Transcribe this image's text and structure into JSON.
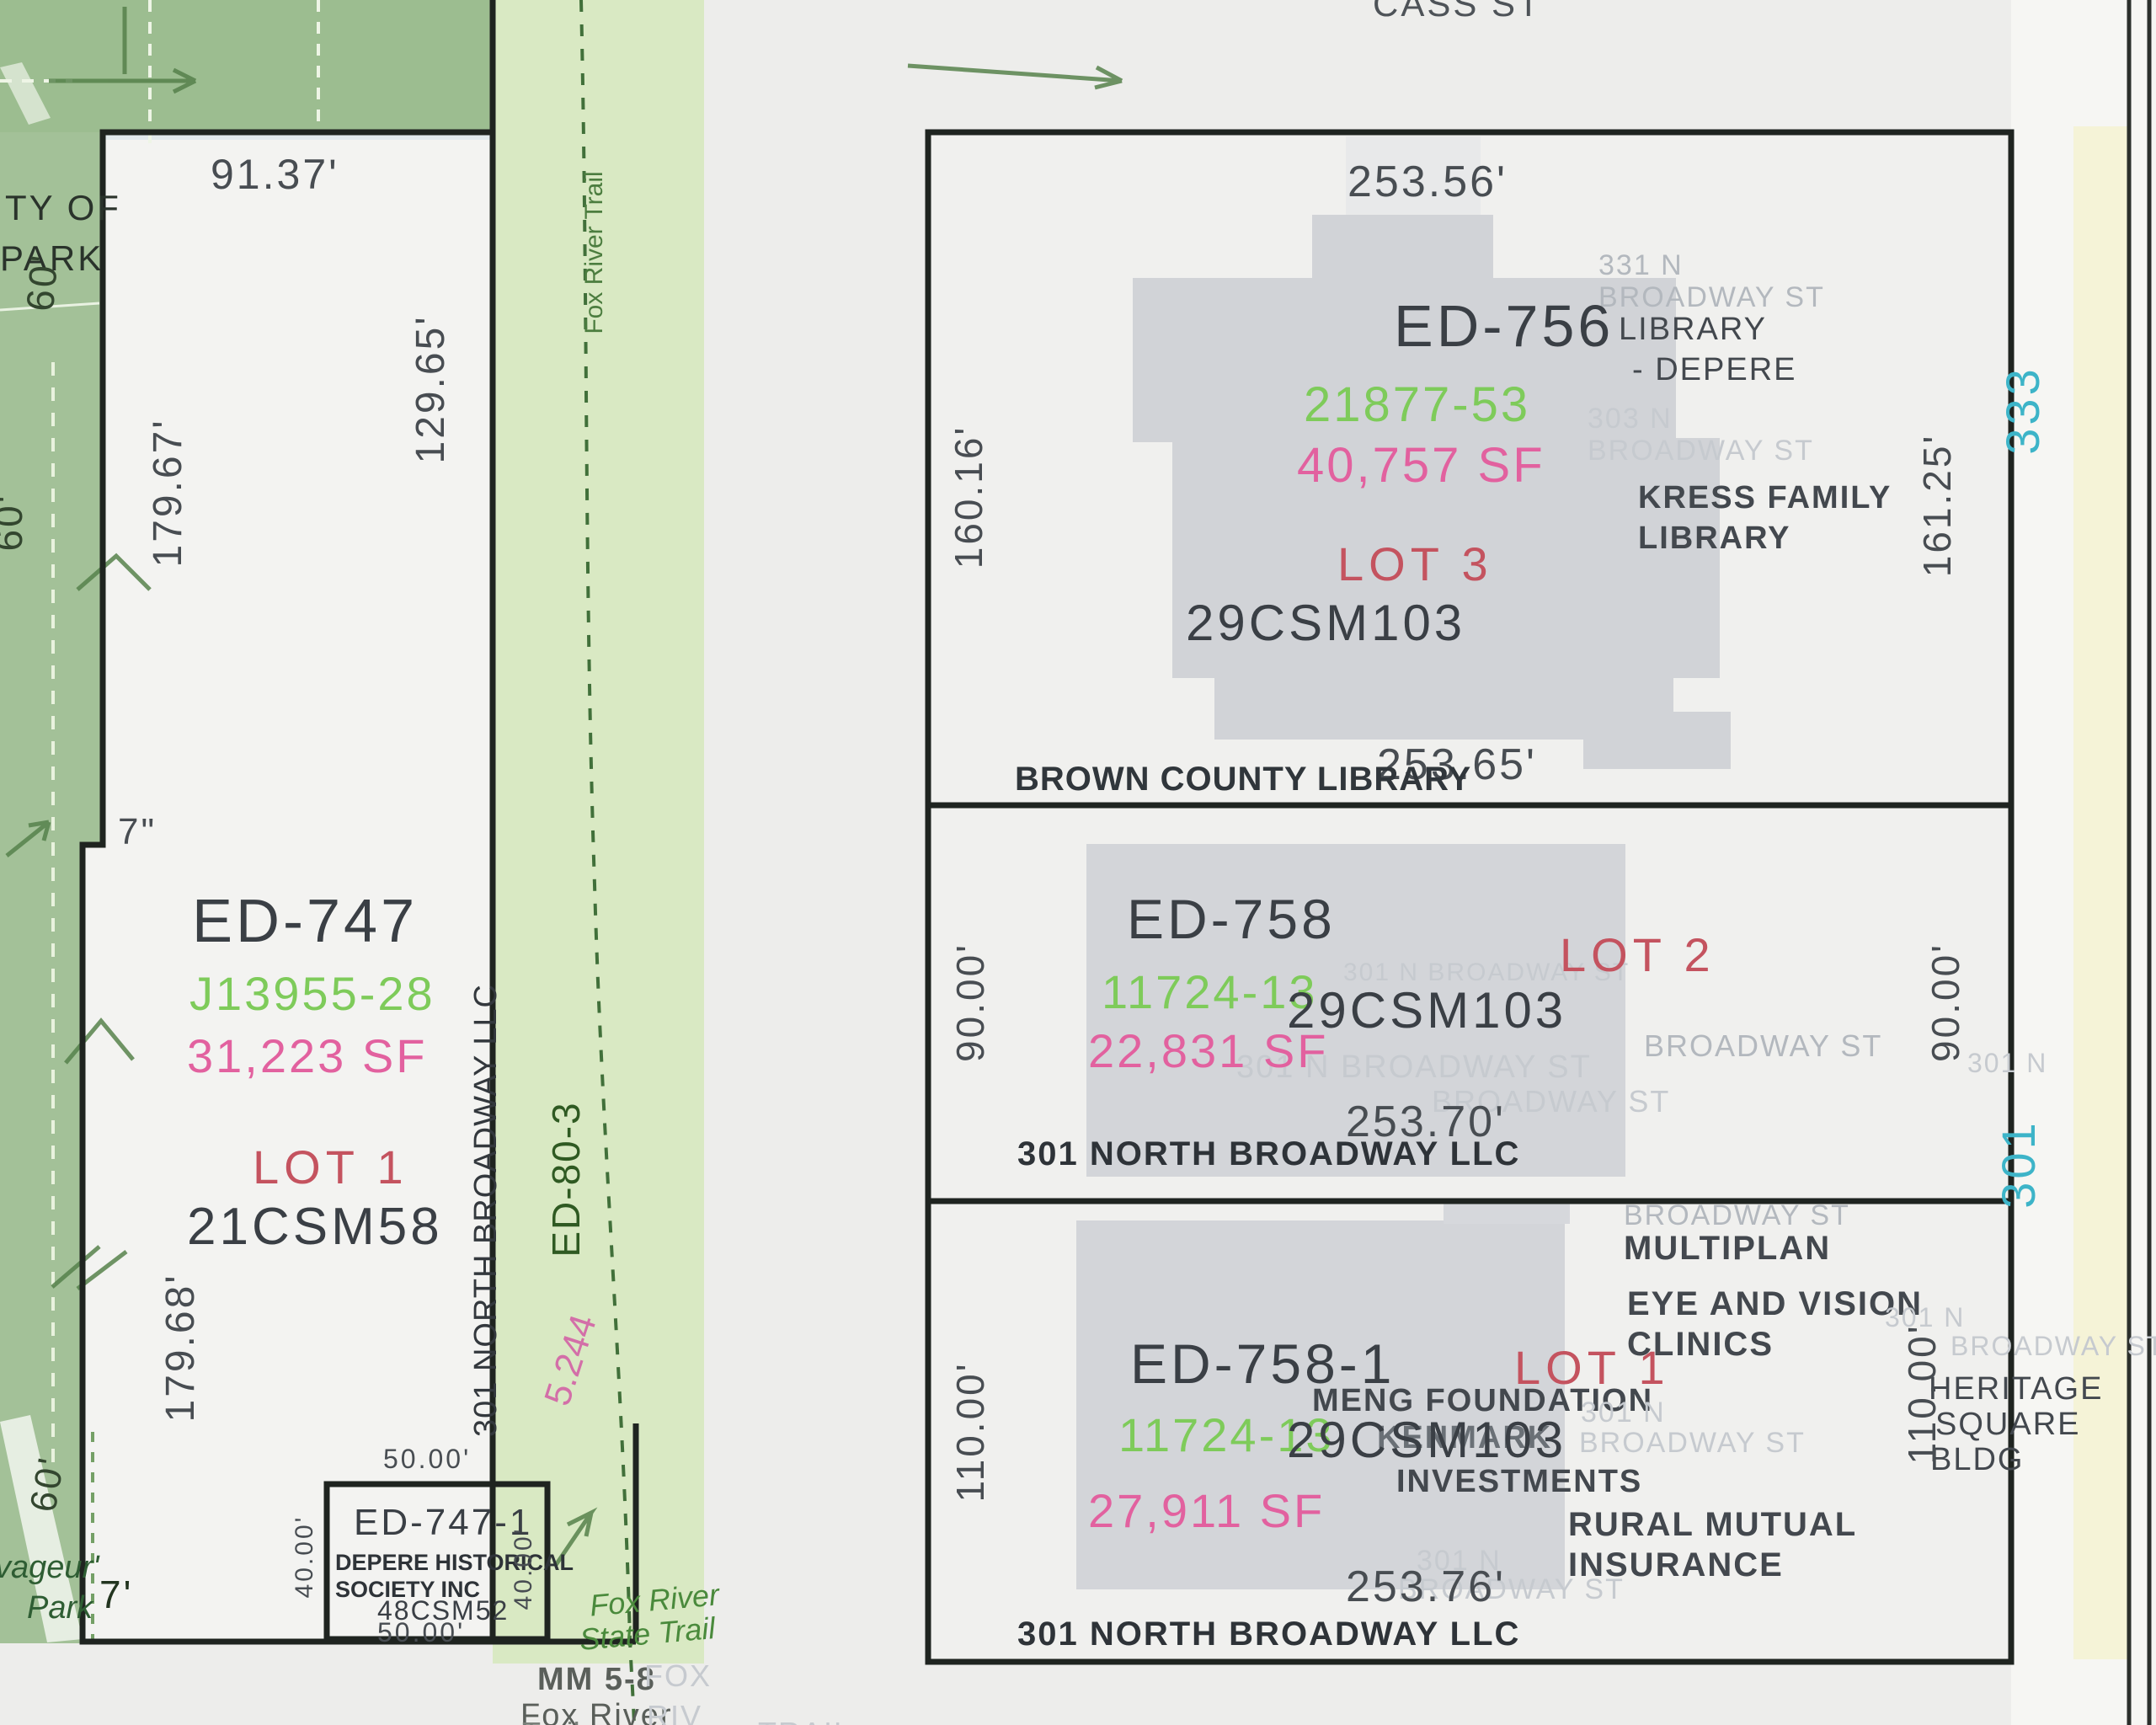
{
  "street": {
    "cass": "CASS ST"
  },
  "colors": {
    "doc_green": "#7ecb5a",
    "area_pink": "#e2619f",
    "lot_red": "#c4535f",
    "addr_cyan": "#3db4c8",
    "park_green": "#a3c198",
    "trail_green": "#d9e9c3"
  },
  "left": {
    "city1": "TY OF",
    "city2": "PARK",
    "d9137": "91.37'",
    "d17967": "179.67'",
    "d12965": "129.65'",
    "d60a": "60'",
    "d60b": "60'",
    "d60c": "60'",
    "jog_in": "7\"",
    "jog_ft": "7'",
    "pid": "ED-747",
    "doc": "J13955-28",
    "sf": "31,223 SF",
    "lot": "LOT 1",
    "csm": "21CSM58",
    "d17968": "179.68'",
    "owner_v": "301 NORTH BROADWAY LLC",
    "voy1": "vageur'",
    "voy2": "Park"
  },
  "hist": {
    "pid": "ED-747-1",
    "own1": "DEPERE HISTORICAL",
    "own2": "SOCIETY INC",
    "csm": "48CSM52",
    "d50t": "50.00'",
    "d50b": "50.00'",
    "d40l": "40.00'",
    "d40r": "40.00'"
  },
  "trail": {
    "name_v": "Fox River Trail",
    "ed80": "ED-80-3",
    "len": "5.244",
    "state1": "Fox River",
    "state2": "State Trail",
    "mm": "MM 5-8",
    "fox2": "Fox River",
    "g_fox": "FOX",
    "g_riv": "RIV",
    "cut1": "Trail",
    "cut2": "TRAIL"
  },
  "lot3": {
    "pid": "ED-756",
    "doc": "21877-53",
    "sf": "40,757 SF",
    "lot": "LOT 3",
    "csm": "29CSM103",
    "lib1": "LIBRARY",
    "lib2": "- DEPERE",
    "kress1": "KRESS FAMILY",
    "kress2": "LIBRARY",
    "brown": "BROWN COUNTY LIBRARY",
    "g331": "331 N",
    "g331b": "BROADWAY ST",
    "g303": "303 N",
    "g303b": "BROADWAY ST",
    "dtop": "253.56'",
    "dbot": "253.65'",
    "dleft": "160.16'",
    "dright": "161.25'",
    "addr": "333"
  },
  "lot2": {
    "pid": "ED-758",
    "doc": "11724-13",
    "sf": "22,831 SF",
    "lot": "LOT 2",
    "csm": "29CSM103",
    "owner": "301 NORTH BROADWAY LLC",
    "dbot": "253.70'",
    "dleft": "90.00'",
    "dright": "90.00'",
    "addr": "301",
    "g1": "301 N BROADWAY ST",
    "g2": "BROADWAY ST",
    "g3": "301 N BROADWAY ST",
    "g4": "BROADWAY ST",
    "g5": "301 N"
  },
  "lot1": {
    "pid": "ED-758-1",
    "doc": "11724-13",
    "sf": "27,911 SF",
    "lot": "LOT 1",
    "csm": "29CSM103",
    "owner": "301 NORTH BROADWAY LLC",
    "dbot": "253.76'",
    "dleft": "110.00'",
    "dright": "110.00'",
    "multiplan": "MULTIPLAN",
    "eye1": "EYE AND VISION",
    "eye2": "CLINICS",
    "meng": "MENG FOUNDATION",
    "kenmark": "KENMARK",
    "invest": "INVESTMENTS",
    "rural1": "RURAL MUTUAL",
    "rural2": "INSURANCE",
    "her1": "HERITAGE",
    "her2": "SQUARE",
    "her3": "BLDG",
    "g1": "BROADWAY ST",
    "g2": "301 N",
    "g3": "BROADWAY ST",
    "g4": "301 N",
    "g5": "BROADWAY ST",
    "g6": "301 N",
    "g7": "BROADWAY ST"
  }
}
